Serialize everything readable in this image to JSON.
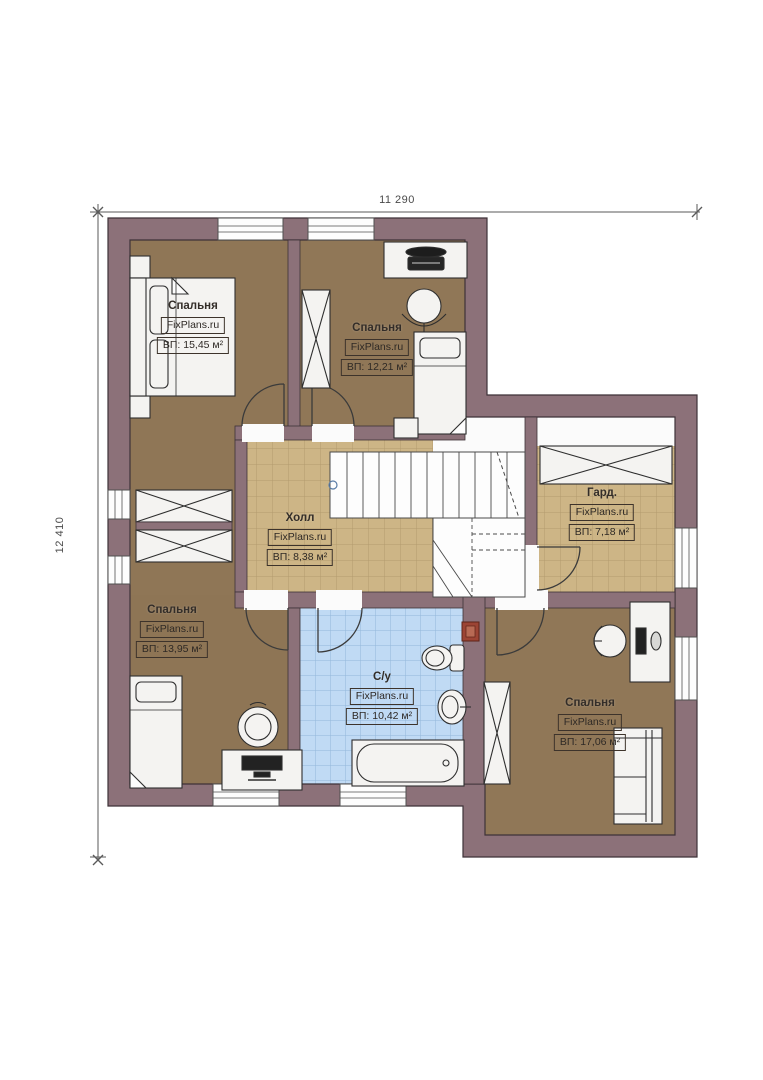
{
  "meta": {
    "type": "floor-plan",
    "brand": "FixPlans.ru"
  },
  "dimensions": {
    "width_label": "11 290",
    "height_label": "12 410"
  },
  "rooms": [
    {
      "id": "bedroom-1",
      "name": "Спальня",
      "brand": "FixPlans.ru",
      "area": "ВП: 15,45 м²"
    },
    {
      "id": "bedroom-2",
      "name": "Спальня",
      "brand": "FixPlans.ru",
      "area": "ВП: 12,21 м²"
    },
    {
      "id": "hall",
      "name": "Холл",
      "brand": "FixPlans.ru",
      "area": "ВП: 8,38 м²"
    },
    {
      "id": "wardrobe",
      "name": "Гард.",
      "brand": "FixPlans.ru",
      "area": "ВП: 7,18 м²"
    },
    {
      "id": "bedroom-3",
      "name": "Спальня",
      "brand": "FixPlans.ru",
      "area": "ВП: 13,95 м²"
    },
    {
      "id": "bathroom",
      "name": "С/у",
      "brand": "FixPlans.ru",
      "area": "ВП: 10,42 м²"
    },
    {
      "id": "bedroom-4",
      "name": "Спальня",
      "brand": "FixPlans.ru",
      "area": "ВП: 17,06 м²"
    }
  ],
  "colors": {
    "wall": "#8c7179",
    "bedroom_floor": "#8f7656",
    "hall_tile": "#cdb586",
    "bath_tile": "#c0daf4",
    "vent_shaft": "#9c4434"
  }
}
